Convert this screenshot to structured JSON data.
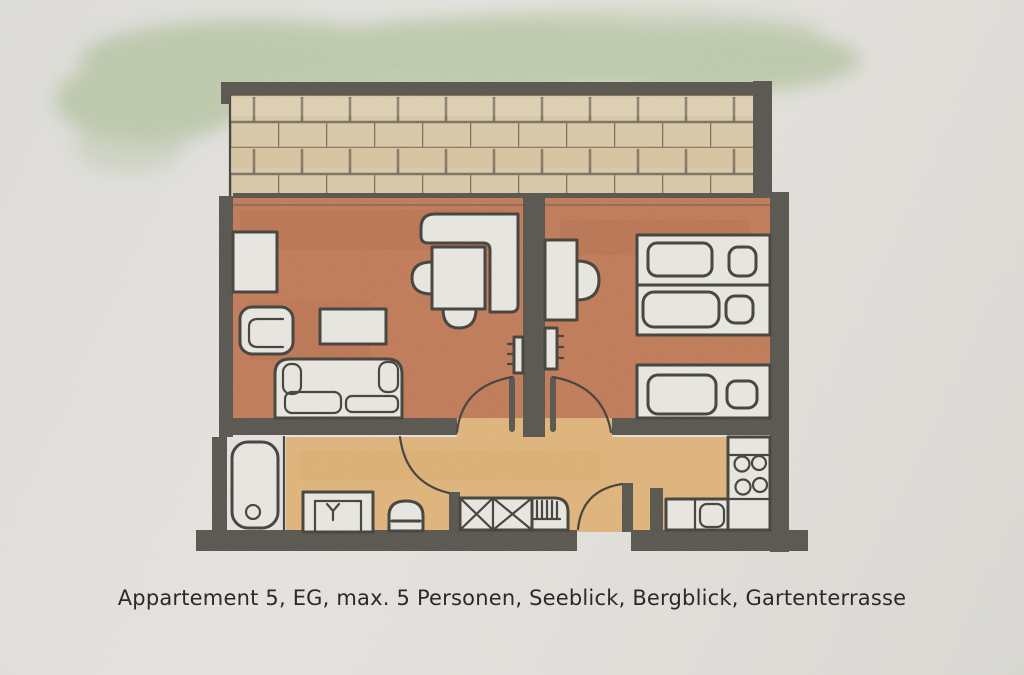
{
  "caption": "Appartement 5, EG, max. 5 Personen, Seeblick, Bergblick, Gartenterrasse",
  "palette": {
    "paper": "#dfddd8",
    "wall": "#53514a",
    "outline": "#3e3d37",
    "floor_red": "#bd7754",
    "floor_orange": "#ddb177",
    "brick": "#d7c6a6",
    "brick_line": "#6d6657",
    "grass": "#9cb483",
    "furniture": "#e6e4df",
    "text": "#2b2a27"
  }
}
